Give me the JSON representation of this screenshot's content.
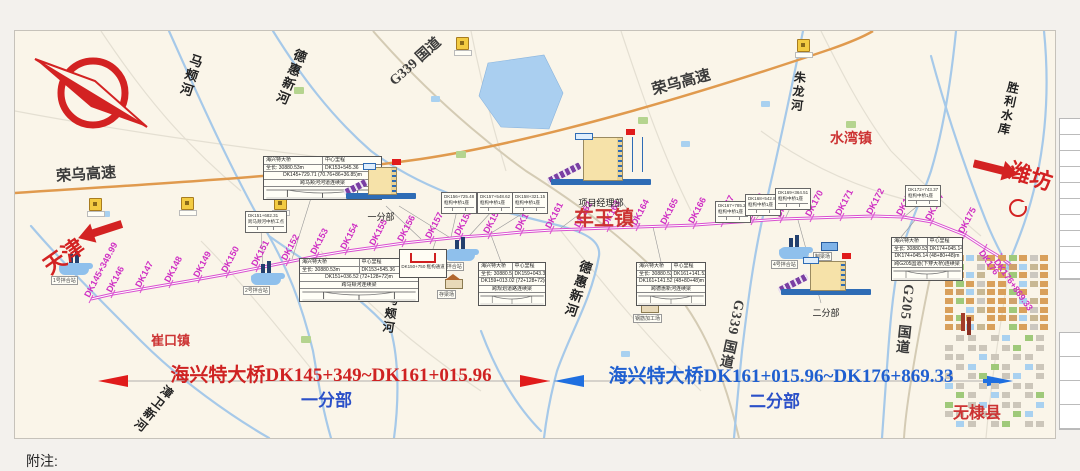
{
  "page": {
    "notes_label": "附注:"
  },
  "nav": {
    "tianjin": {
      "label": "天津"
    },
    "weifang": {
      "label": "潍坊"
    }
  },
  "sections": {
    "left": {
      "title": "海兴特大桥DK145+349~DK161+015.96",
      "subtitle": "一分部",
      "title_color": "#cf2222"
    },
    "right": {
      "title": "海兴特大桥DK161+015.96~DK176+869.33",
      "subtitle": "二分部",
      "title_color": "#1f5fd0"
    }
  },
  "towns": [
    {
      "label": "崔口镇",
      "x": 150,
      "y": 329,
      "size": 13
    },
    {
      "label": "车王镇",
      "x": 573,
      "y": 201,
      "size": 20
    },
    {
      "label": "水湾镇",
      "x": 829,
      "y": 127,
      "size": 14
    },
    {
      "label": "无棣县",
      "x": 952,
      "y": 398,
      "size": 16
    }
  ],
  "waterways": [
    {
      "label": "马颊河",
      "x": 180,
      "y": 52,
      "rot": 18,
      "size": 13
    },
    {
      "label": "德惠新河",
      "x": 280,
      "y": 46,
      "rot": 22,
      "size": 13
    },
    {
      "label": "马颊河",
      "x": 381,
      "y": 292,
      "rot": 8,
      "size": 12
    },
    {
      "label": "德惠新河",
      "x": 567,
      "y": 258,
      "rot": 18,
      "size": 13
    },
    {
      "label": "朱龙河",
      "x": 789,
      "y": 70,
      "rot": 6,
      "size": 12
    },
    {
      "label": "胜利水库",
      "x": 999,
      "y": 80,
      "rot": 12,
      "size": 12
    },
    {
      "label": "漳卫新河",
      "x": 144,
      "y": 380,
      "rot": 38,
      "size": 12
    }
  ],
  "road_labels": [
    {
      "label": "荣乌高速",
      "x": 55,
      "y": 162,
      "rot": -4,
      "size": 15,
      "vertical": false
    },
    {
      "label": "荣乌高速",
      "x": 650,
      "y": 70,
      "rot": -15,
      "size": 15,
      "vertical": false
    },
    {
      "label": "G339 国道",
      "x": 382,
      "y": 50,
      "rot": -42,
      "size": 14,
      "vertical": false
    },
    {
      "label": "G339 国道",
      "x": 720,
      "y": 298,
      "rot": 12,
      "size": 14,
      "vertical": true
    },
    {
      "label": "G205 国道",
      "x": 893,
      "y": 283,
      "rot": 6,
      "size": 14,
      "vertical": true
    }
  ],
  "alignment": {
    "color": "#d94fd0",
    "markers": [
      {
        "label": "DK145+349.99",
        "x": 90,
        "y": 298
      },
      {
        "label": "DK146",
        "x": 112,
        "y": 293
      },
      {
        "label": "DK147",
        "x": 141,
        "y": 288
      },
      {
        "label": "DK148",
        "x": 170,
        "y": 283
      },
      {
        "label": "DK149",
        "x": 199,
        "y": 278
      },
      {
        "label": "DK150",
        "x": 227,
        "y": 273
      },
      {
        "label": "DK151",
        "x": 257,
        "y": 267
      },
      {
        "label": "DK152",
        "x": 287,
        "y": 261
      },
      {
        "label": "DK153",
        "x": 316,
        "y": 255
      },
      {
        "label": "DK154",
        "x": 346,
        "y": 250
      },
      {
        "label": "DK155",
        "x": 375,
        "y": 246
      },
      {
        "label": "DK156",
        "x": 403,
        "y": 242
      },
      {
        "label": "DK157",
        "x": 431,
        "y": 239
      },
      {
        "label": "DK158",
        "x": 460,
        "y": 236
      },
      {
        "label": "DK159",
        "x": 489,
        "y": 234
      },
      {
        "label": "DK160",
        "x": 521,
        "y": 231
      },
      {
        "label": "DK161",
        "x": 551,
        "y": 229
      },
      {
        "label": "DK162",
        "x": 580,
        "y": 228
      },
      {
        "label": "DK163",
        "x": 608,
        "y": 227
      },
      {
        "label": "DK164",
        "x": 637,
        "y": 226
      },
      {
        "label": "DK165",
        "x": 666,
        "y": 225
      },
      {
        "label": "DK166",
        "x": 694,
        "y": 224
      },
      {
        "label": "DK167",
        "x": 722,
        "y": 222
      },
      {
        "label": "DK168",
        "x": 752,
        "y": 220
      },
      {
        "label": "DK169",
        "x": 781,
        "y": 218
      },
      {
        "label": "DK170",
        "x": 811,
        "y": 217
      },
      {
        "label": "DK171",
        "x": 841,
        "y": 216
      },
      {
        "label": "DK172",
        "x": 872,
        "y": 215
      },
      {
        "label": "DK173",
        "x": 902,
        "y": 216
      },
      {
        "label": "DK174",
        "x": 931,
        "y": 221
      },
      {
        "label": "DK175",
        "x": 964,
        "y": 234
      },
      {
        "label": "DK176",
        "x": 984,
        "y": 247,
        "rot": 55
      },
      {
        "label": "DK176+869.33",
        "x": 999,
        "y": 256,
        "rot": 55
      }
    ]
  },
  "hq_sites": [
    {
      "label": "一分部",
      "x": 345,
      "y": 160,
      "w": 70,
      "h": 48,
      "big": false
    },
    {
      "label": "项目经理部",
      "x": 550,
      "y": 130,
      "w": 100,
      "h": 64,
      "big": true
    },
    {
      "label": "二分部",
      "x": 780,
      "y": 254,
      "w": 90,
      "h": 50,
      "big": false
    }
  ],
  "facilities": [
    {
      "type": "plant",
      "label": "1号拌合站",
      "x": 58,
      "y": 250
    },
    {
      "type": "plant",
      "label": "2号拌合站",
      "x": 250,
      "y": 260
    },
    {
      "type": "plant",
      "label": "3号拌合站",
      "x": 444,
      "y": 236
    },
    {
      "type": "plant",
      "label": "4号拌合站",
      "x": 778,
      "y": 234
    },
    {
      "type": "house",
      "label": "存梁场",
      "x": 444,
      "y": 264
    },
    {
      "type": "house",
      "label": "钢筋加工场",
      "x": 640,
      "y": 288
    },
    {
      "type": "shed",
      "label": "制梁场",
      "x": 820,
      "y": 226
    }
  ],
  "info_boxes": [
    {
      "x": 262,
      "y": 155,
      "w": 117,
      "name": "海兴特大桥",
      "center_label": "中心里程",
      "length": "全长: 30880.53m",
      "center": "DK153+545.36",
      "span": "DK145+729.71 (70.76+86+36.85)m",
      "desc": "跨马颊河河道连续梁",
      "leader": [
        310,
        197,
        291,
        258
      ]
    },
    {
      "x": 298,
      "y": 257,
      "w": 118,
      "name": "海兴特大桥",
      "center_label": "中心里程",
      "length": "全长: 30880.53m",
      "center": "DK153+545.36",
      "span": "DK151+036.52 (72+128+72)m",
      "desc": "跨马颊河连续梁",
      "leader": [
        320,
        257,
        298,
        261
      ]
    },
    {
      "x": 477,
      "y": 261,
      "w": 66,
      "name": "海兴特大桥",
      "center_label": "中心里程",
      "length": "全长: 30880.53m",
      "center": "DK159+043.31",
      "span": "DK159+013.02 (72+128+72)m",
      "desc": "跨规划道路连续梁",
      "leader": [
        500,
        261,
        490,
        234
      ]
    },
    {
      "x": 635,
      "y": 261,
      "w": 68,
      "name": "海兴特大桥",
      "center_label": "中心里程",
      "length": "全长: 30880.53m",
      "center": "DK161+141.52",
      "span": "DK161+141.52 (48+80+48)m",
      "desc": "跨德惠新河连续梁",
      "leader": [
        660,
        261,
        652,
        226
      ]
    },
    {
      "x": 890,
      "y": 236,
      "w": 70,
      "name": "海兴特大桥",
      "center_label": "中心里程",
      "length": "全长: 30880.53m",
      "center": "DK174+045.14",
      "span": "DK174+045.14 (48+80+48)m",
      "desc": "跨G205国道(下穿大桥)连续梁",
      "leader": [
        900,
        236,
        915,
        218
      ]
    }
  ],
  "callouts": [
    {
      "x": 244,
      "y": 210,
      "line1": "DK151+682.31",
      "line2": "跨马颊河中桥工点",
      "tx": 262,
      "ty": 266
    },
    {
      "x": 440,
      "y": 191,
      "line1": "DK156+725.48",
      "line2": "框构中桥1座",
      "tx": 450,
      "ty": 236
    },
    {
      "x": 476,
      "y": 191,
      "line1": "DK157+548.62",
      "line2": "框构中桥1座",
      "tx": 468,
      "ty": 235
    },
    {
      "x": 511,
      "y": 191,
      "line1": "DK158+321.15",
      "line2": "框构中桥1座",
      "tx": 487,
      "ty": 234
    },
    {
      "x": 714,
      "y": 200,
      "line1": "DK167+785.23",
      "line2": "框构中桥1座",
      "tx": 724,
      "ty": 222
    },
    {
      "x": 744,
      "y": 193,
      "line1": "DK168+542.87",
      "line2": "框构中桥1座",
      "tx": 754,
      "ty": 220
    },
    {
      "x": 774,
      "y": 187,
      "line1": "DK169+364.51",
      "line2": "框构中桥1座",
      "tx": 784,
      "ty": 218
    },
    {
      "x": 904,
      "y": 184,
      "line1": "DK172+743.37",
      "line2": "框构中桥1座",
      "tx": 903,
      "ty": 216
    }
  ],
  "culvert": {
    "x": 398,
    "y": 248,
    "caption": "DK150+750 框构通道",
    "leader": [
      423,
      275,
      435,
      239
    ]
  },
  "colors": {
    "alignment": "#d94fd0",
    "river": "#a6c9e9",
    "expressway": "#e09a4e",
    "road": "#d4cbb4",
    "red": "#d32222",
    "blue": "#1f6fe0"
  }
}
